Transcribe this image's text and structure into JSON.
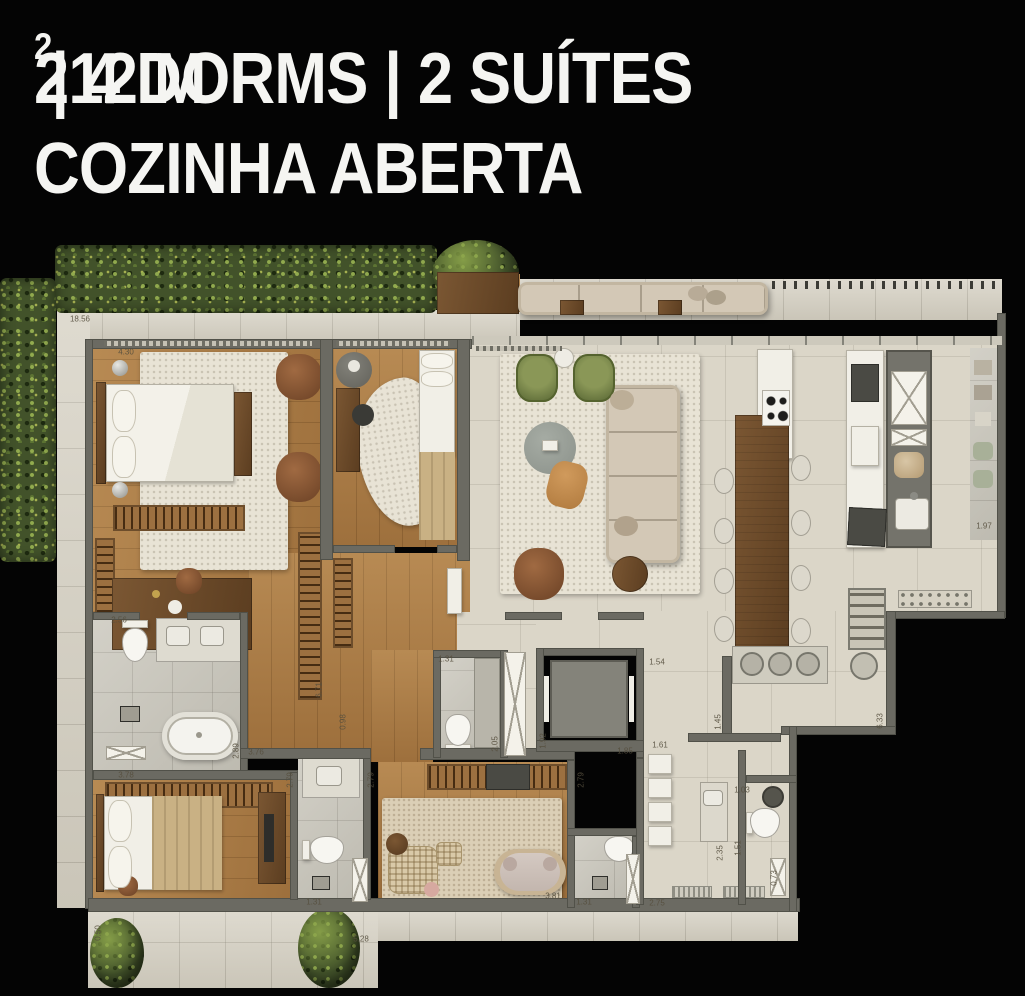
{
  "header": {
    "line1_prefix": "212 M",
    "line1_sup": "2",
    "line1_suffix": " | 4 DORMS | 2 SUÍTES",
    "line2": "COZINHA ABERTA"
  },
  "plan": {
    "dimensions": [
      {
        "v": "18.56",
        "x": 80,
        "y": 319,
        "r": 0
      },
      {
        "v": "4.30",
        "x": 126,
        "y": 352,
        "r": 0
      },
      {
        "v": "2.56",
        "x": 119,
        "y": 620,
        "r": 0
      },
      {
        "v": "3.78",
        "x": 126,
        "y": 775,
        "r": 0
      },
      {
        "v": "2.89",
        "x": 236,
        "y": 751,
        "r": -90
      },
      {
        "v": "3.76",
        "x": 256,
        "y": 752,
        "r": 0
      },
      {
        "v": "6.71",
        "x": 319,
        "y": 690,
        "r": -90
      },
      {
        "v": "0.98",
        "x": 343,
        "y": 722,
        "r": -90
      },
      {
        "v": "2.79",
        "x": 290,
        "y": 780,
        "r": -90
      },
      {
        "v": "2.79",
        "x": 371,
        "y": 780,
        "r": -90
      },
      {
        "v": "2.79",
        "x": 581,
        "y": 780,
        "r": -90
      },
      {
        "v": "1.31",
        "x": 314,
        "y": 902,
        "r": 0
      },
      {
        "v": "1.31",
        "x": 584,
        "y": 902,
        "r": 0
      },
      {
        "v": "3.81",
        "x": 553,
        "y": 896,
        "r": 0
      },
      {
        "v": "2.75",
        "x": 657,
        "y": 903,
        "r": 0
      },
      {
        "v": "0.73",
        "x": 774,
        "y": 878,
        "r": -90
      },
      {
        "v": "1.51",
        "x": 738,
        "y": 848,
        "r": -90
      },
      {
        "v": "1.03",
        "x": 742,
        "y": 790,
        "r": 0
      },
      {
        "v": "2.35",
        "x": 720,
        "y": 853,
        "r": -90
      },
      {
        "v": "1.61",
        "x": 660,
        "y": 745,
        "r": 0
      },
      {
        "v": "1.85",
        "x": 625,
        "y": 751,
        "r": 0
      },
      {
        "v": "1.92",
        "x": 543,
        "y": 741,
        "r": -90
      },
      {
        "v": "1.54",
        "x": 657,
        "y": 662,
        "r": 0
      },
      {
        "v": "1.45",
        "x": 718,
        "y": 722,
        "r": -90
      },
      {
        "v": "6.33",
        "x": 880,
        "y": 721,
        "r": -90
      },
      {
        "v": "1.97",
        "x": 984,
        "y": 526,
        "r": 0
      },
      {
        "v": "1.31",
        "x": 446,
        "y": 659,
        "r": 0
      },
      {
        "v": "2.05",
        "x": 495,
        "y": 744,
        "r": -90
      },
      {
        "v": "0.50",
        "x": 98,
        "y": 933,
        "r": -90
      },
      {
        "v": "5.28",
        "x": 361,
        "y": 939,
        "r": 0
      }
    ]
  },
  "colors": {
    "background": "#040404",
    "text": "#f5f5f2",
    "wall": "#6b6a62",
    "wood": "#ab7b44",
    "tile": "#d5d0c2",
    "bath_tile": "#c9c6bb",
    "hedge_green": "#42522a",
    "rug_ivory": "#e8e3d5",
    "armchair_green": "#66743e",
    "leather_brown": "#8a5a38",
    "ottoman_tan": "#c28b4e",
    "dim_text": "#564f3e"
  }
}
